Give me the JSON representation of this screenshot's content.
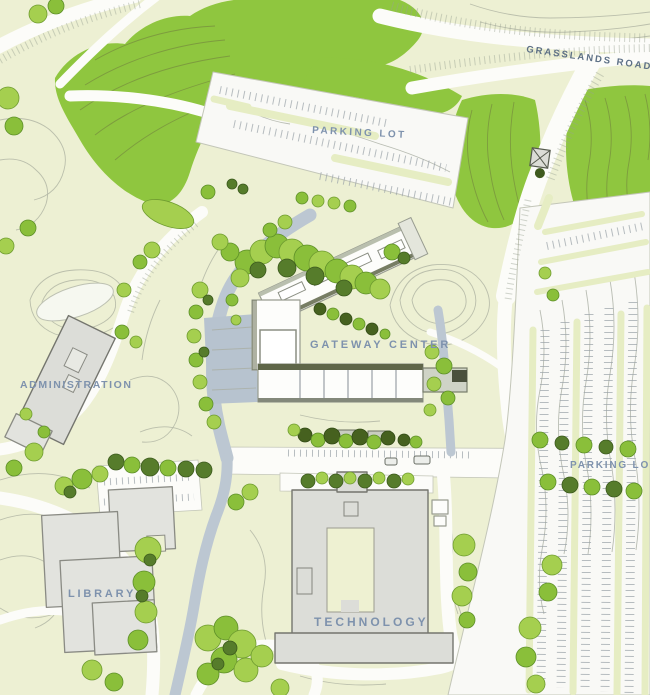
{
  "map": {
    "type": "campus-site-plan",
    "labels": {
      "grasslands_road": "GRASSLANDS ROAD",
      "parking_lot_north": "PARKING LOT",
      "gateway_center": "GATEWAY CENTER",
      "administration": "ADMINISTRATION",
      "parking_lot_east": "PARKING LOT",
      "library": "LIBRARY",
      "technology": "TECHNOLOGY"
    },
    "colors": {
      "background": "#edf0d3",
      "vegetation": "#8fc63f",
      "vegetation_dark": "#567c2b",
      "road_white": "#fcfcf9",
      "paved_plaza_blue": "#bcc7d2",
      "building_gray": "#dcddd8",
      "building_white": "#fdfdfb",
      "roof_accent_olive": "#5f6649",
      "parking_island_green": "#e6edc3",
      "contour_gray": "#b2b6a5",
      "label_blue": "#7e92ad",
      "label_dark_blue": "#5d7086"
    }
  }
}
